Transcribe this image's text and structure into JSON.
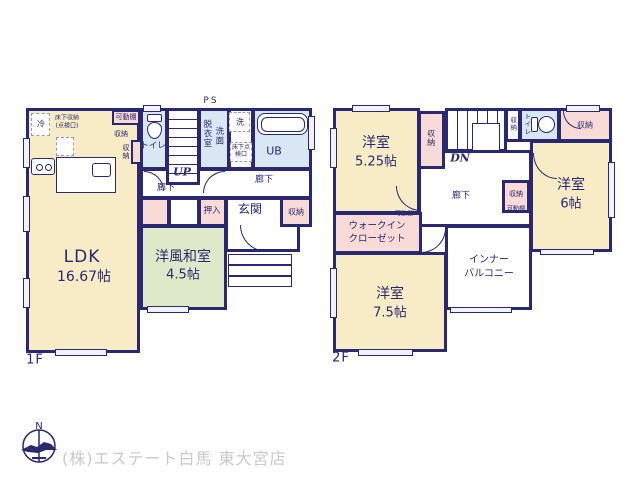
{
  "colors": {
    "wall": "#2a2870",
    "room_cream": "#f8ecc6",
    "tatami_green": "#dde9c9",
    "closet_pink": "#f8dbd6",
    "wet_area_blue": "#d9e6f4",
    "footer_text": "#c9c9c9"
  },
  "floor1": {
    "label": "1F",
    "ps": "PS",
    "ldk_name": "LDK",
    "ldk_size": "16.67帖",
    "kadodana": "可動棚",
    "shuno_a": "収納",
    "shuno_b": "収納",
    "toilet": "トイレ",
    "up": "UP",
    "datsui": "脱衣室",
    "senmen": "洗面",
    "laundry": "洗",
    "yukashita_tenken": "床下点検口",
    "ub": "UB",
    "hall_a": "廊下",
    "hall_b": "廊下",
    "oshiire": "押入",
    "genkan": "玄関",
    "shuno_c": "収納",
    "washitsu_name": "洋風和室",
    "washitsu_size": "4.5帖",
    "rei": "冷",
    "yukashita_shuno": "床下収納",
    "tenkenko": "(点検口)"
  },
  "floor2": {
    "label": "2F",
    "dn": "DN",
    "room525_name": "洋室",
    "room525_size": "5.25帖",
    "room6_name": "洋室",
    "room6_size": "6帖",
    "room75_name": "洋室",
    "room75_size": "7.5帖",
    "toilet": "トイレ",
    "shuno_stairs": "収納",
    "shuno_small": "収納",
    "shuno_tr": "収納",
    "shuno_mid": "収納",
    "kadodana_mid": "可動棚",
    "kadodana_wic": "可動棚",
    "wic1": "ウォークイン",
    "wic2": "クローゼット",
    "hall": "廊下",
    "balcony1": "インナー",
    "balcony2": "バルコニー"
  },
  "footer": {
    "company": "(株)エステート白馬 東大宮店",
    "compass_north": "N"
  }
}
